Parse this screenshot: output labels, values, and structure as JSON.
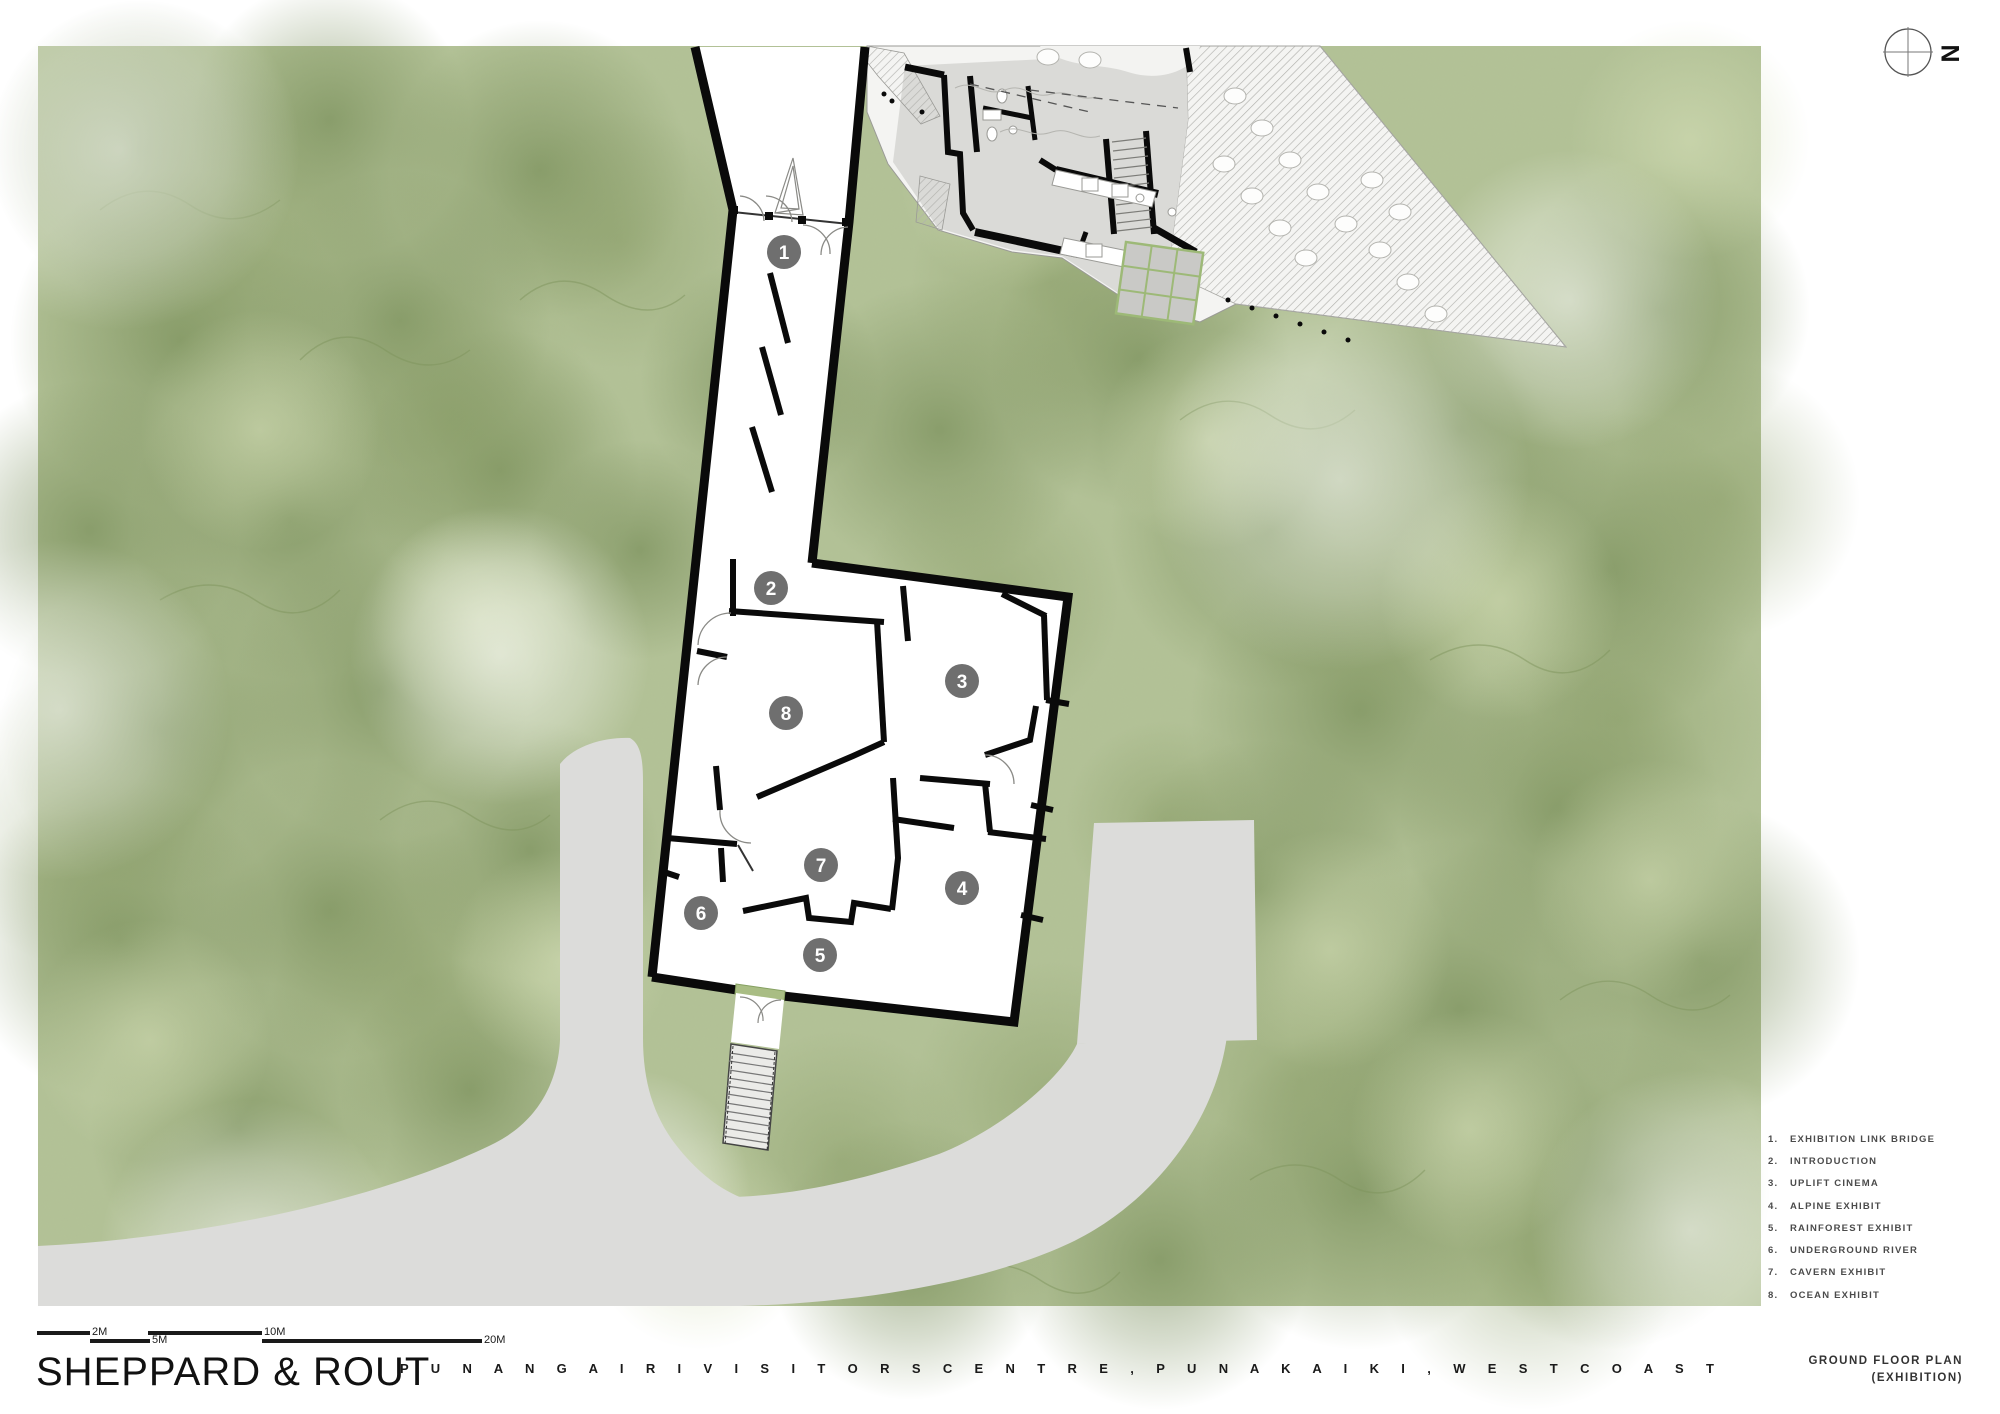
{
  "title_block": {
    "firm": "SHEPPARD & ROUT",
    "project": "P U N A N G A I R I   V I S I T O R S   C E N T R E ,   P U N A K A I K I ,   W E S T   C O A S T",
    "drawing_title": "GROUND FLOOR PLAN",
    "drawing_subtitle": "(EXHIBITION)"
  },
  "north": {
    "label": "N"
  },
  "scale_bar": {
    "labels": [
      "2M",
      "5M",
      "10M",
      "20M"
    ]
  },
  "legend": {
    "items": [
      {
        "num": "1.",
        "label": "EXHIBITION LINK BRIDGE"
      },
      {
        "num": "2.",
        "label": "INTRODUCTION"
      },
      {
        "num": "3.",
        "label": "UPLIFT CINEMA"
      },
      {
        "num": "4.",
        "label": "ALPINE EXHIBIT"
      },
      {
        "num": "5.",
        "label": "RAINFOREST EXHIBIT"
      },
      {
        "num": "6.",
        "label": "UNDERGROUND RIVER"
      },
      {
        "num": "7.",
        "label": "CAVERN EXHIBIT"
      },
      {
        "num": "8.",
        "label": "OCEAN EXHIBIT"
      }
    ]
  },
  "plan": {
    "markers": [
      {
        "num": "1"
      },
      {
        "num": "2"
      },
      {
        "num": "3"
      },
      {
        "num": "4"
      },
      {
        "num": "5"
      },
      {
        "num": "6"
      },
      {
        "num": "7"
      },
      {
        "num": "8"
      }
    ]
  },
  "colors": {
    "vegetation": "#b3c296",
    "path_grey": "#dcdcda",
    "wall_black": "#0a0a0a",
    "marker_grey": "#6f6f6f",
    "canopy_green": "#9db977",
    "landing_green": "#a9bd84"
  }
}
